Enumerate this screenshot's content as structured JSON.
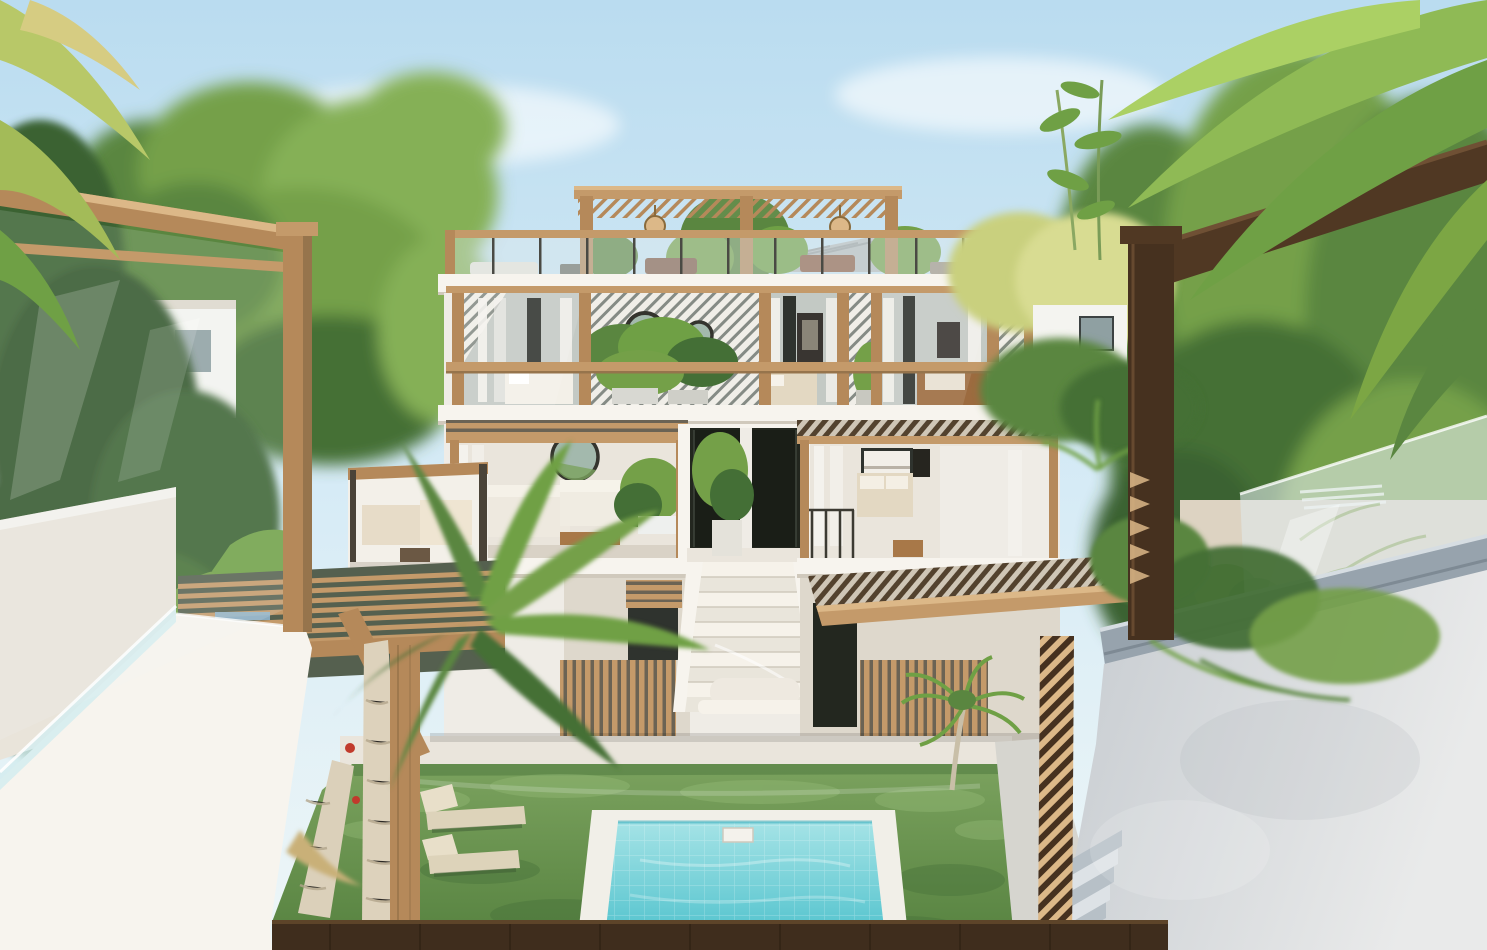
{
  "scene": {
    "type": "architectural-render",
    "subject": "tropical-villa-with-pool-courtyard",
    "elements": {
      "building": "three-story-white-villa",
      "rooftop": "wood-pergola-roof-terrace",
      "stairs": "central-entry-staircase",
      "pool": "turquoise-plunge-pool",
      "yard": "green-lawn-with-loungers",
      "foreground_left": "white-parapet-wall-with-wood-pergola",
      "foreground_right": "gray-concrete-wall-with-dark-wood-pergola"
    }
  },
  "palette": {
    "sky_top": "#badcf0",
    "sky_mid": "#d8ecf6",
    "sky_low": "#eef6f7",
    "cloud": "#ffffff",
    "tree_green_1": "#74a048",
    "tree_green_2": "#5a8640",
    "tree_green_3": "#85b057",
    "tree_green_dark": "#446f36",
    "jungle_dark": "#3a6233",
    "jungle_darker": "#31552c",
    "tree_yellow": "#d8dc92",
    "tree_yellow2": "#c9d07e",
    "palm_green": "#8fba55",
    "palm_green2": "#6fa045",
    "palm_light": "#abd064",
    "wood_light": "#c49a6a",
    "wood_light_hi": "#dcb888",
    "wood_mid": "#b5895a",
    "wood_shade": "#96744c",
    "wood_grain": "#8f6d46",
    "wood_dark": "#503823",
    "wood_dark2": "#46311f",
    "wood_dark_hi": "#6f5034",
    "bldg_white": "#f7f4ee",
    "bldg_white2": "#efece6",
    "bldg_shadow": "#ded8cc",
    "slab_shadow": "#d0c9bc",
    "glass": "#c3c9c4",
    "glass_dark": "#2f332e",
    "door_dark": "#1a1e17",
    "entry_dark": "#23271f",
    "curtain": "#f4f2ed",
    "interior": "#eae5dc",
    "interior_floor": "#d9d2c6",
    "bed_white": "#f3f0e8",
    "bed_beige": "#e3d8c2",
    "rattan": "#9c6b3f",
    "art_dark": "#393531",
    "table_wood": "#a87848",
    "mirror_fill": "#a3b9ad",
    "mirror_rim": "#34342e",
    "slat_line": "#858b85",
    "slat_bg": "#f0eee8",
    "dkslat_bg": "#cfc6b6",
    "dkslat_line": "#53422e",
    "fence_gap": "#6b6354",
    "lawn1": "#7ba25e",
    "lawn2": "#55813f",
    "lawn_dark": "#46703a",
    "lawn_light": "#96bb78",
    "paving": "#eae5dc",
    "paving_lit": "#f6f2ea",
    "pool_rim": "#f1efe8",
    "pool1": "#a5e3e6",
    "pool2": "#58c5cf",
    "pool_deep": "#3fb0bf",
    "lounger": "#ddd3ba",
    "lounger2": "#e8dfc9",
    "gray_wall1": "#c6cbd0",
    "gray_wall2": "#e9eaea",
    "coping": "#97a3ad",
    "coping_hi": "#d6dde2",
    "step_dark": "#b7c0c7",
    "step_light": "#dde2e6",
    "glass_rail": "#dfe9ea",
    "beige_wall": "#ddd3c2",
    "trunk": "#dbd0ba",
    "trunk_shade": "#b3a68c",
    "strip_dark": "#3f2d1d",
    "strip_grain": "#2e2113",
    "strip_hi": "#5d4429",
    "flower_red": "#c13a2c",
    "pergola_gray": "#b6bcbe",
    "pergola_gray_line": "#99a0a2",
    "white_bldg": "#f4f4f0",
    "window_glass": "#8fa0a2"
  }
}
